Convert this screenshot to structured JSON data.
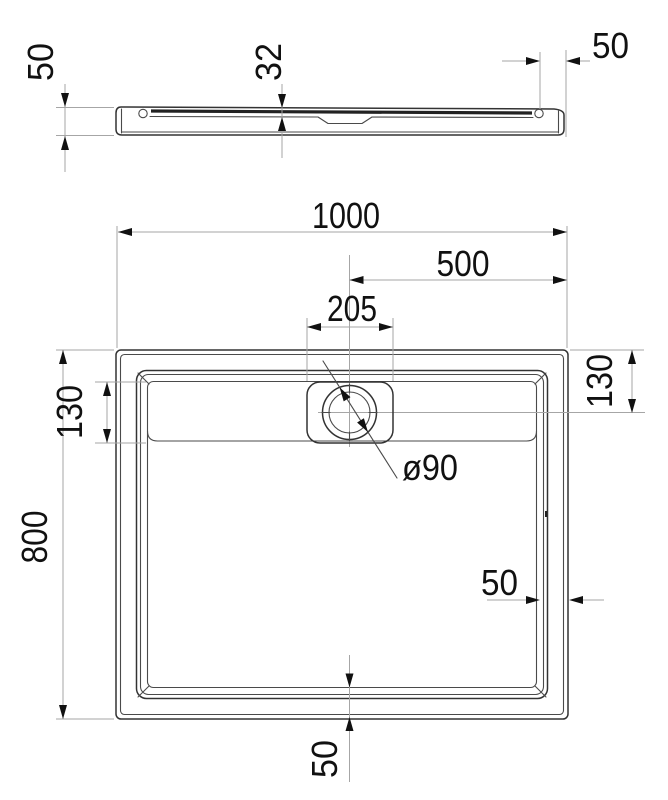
{
  "drawing": {
    "subject": "shower tray technical drawing, side section and plan view",
    "units": "mm",
    "colors": {
      "object_line": "#333333",
      "dimension_line": "#a6a6a6",
      "text": "#111111",
      "background": "#ffffff"
    },
    "side_view": {
      "dim_height_left": "50",
      "dim_depth": "32",
      "dim_edge_right": "50"
    },
    "plan_view": {
      "dim_width": "1000",
      "dim_center_offset": "500",
      "dim_drain_width": "205",
      "dim_drain_left": "130",
      "dim_drain_right": "130",
      "dim_height": "800",
      "dim_rim_right": "50",
      "dim_rim_bottom": "50",
      "dim_drain_diameter": "ø90"
    }
  }
}
